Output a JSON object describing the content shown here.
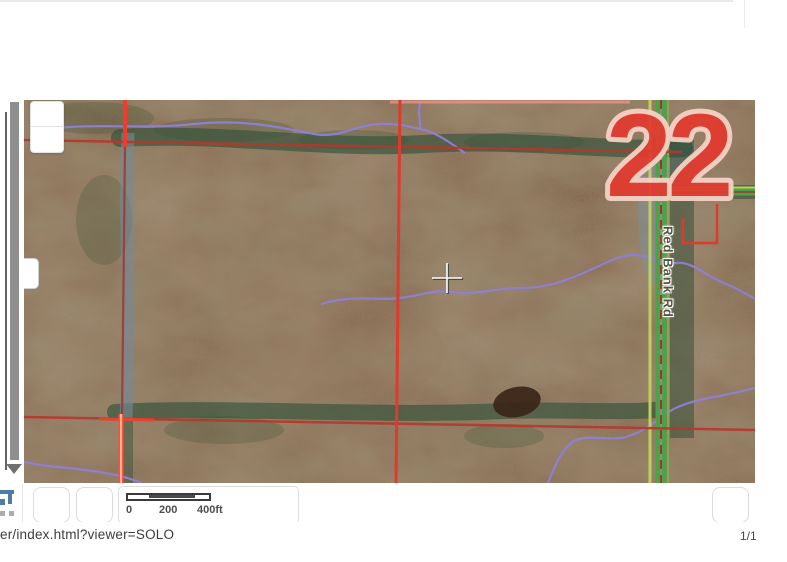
{
  "map": {
    "section_number": "22",
    "road_label": "Red Bank Rd",
    "colors": {
      "section_number_fill": "#e23b30",
      "section_number_outline": "#f7d2c6",
      "section_line_red": "#b5372b",
      "road_green": "#4ba24a",
      "stream_purple": "#8f7fd8",
      "ground_brown": "#826649"
    }
  },
  "scalebar": {
    "start": "0",
    "middle": "200",
    "end": "400ft"
  },
  "statusbar": {
    "url_text": "er/index.html?viewer=SOLO",
    "page_indicator": "1/1"
  }
}
